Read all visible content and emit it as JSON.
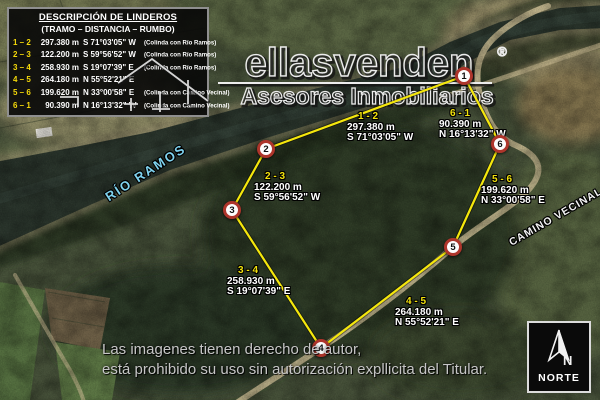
{
  "legend": {
    "title": "DESCRIPCIÓN DE LINDEROS",
    "subtitle": "(TRAMO – DISTANCIA – RUMBO)",
    "rows": [
      {
        "segment": "1 – 2",
        "distance": "297.380 m",
        "bearing": "S 71°03'05\" W",
        "note": "(Colinda con Río Ramos)"
      },
      {
        "segment": "2 – 3",
        "distance": "122.200 m",
        "bearing": "S 59°56'52\" W",
        "note": "(Colinda con Río Ramos)"
      },
      {
        "segment": "3 – 4",
        "distance": "258.930 m",
        "bearing": "S 19°07'39\" E",
        "note": "(Colinda con Río Ramos)"
      },
      {
        "segment": "4 – 5",
        "distance": "264.180 m",
        "bearing": "N 55°52'21\" E",
        "note": ""
      },
      {
        "segment": "5 – 6",
        "distance": "199.620 m",
        "bearing": "N 33°00'58\" E",
        "note": "(Colinda con Camino Vecinal)"
      },
      {
        "segment": "6 – 1",
        "distance": "90.390 m",
        "bearing": "N 16°13'32\" W",
        "note": "(Colinda con Camino Vecinal)"
      }
    ]
  },
  "watermark": {
    "brand": "ellasvenden",
    "registered": "®",
    "tagline": "Asesores Inmobiliarios"
  },
  "map_labels": {
    "river": "RÍO RAMOS",
    "road": "CAMINO VECINAL"
  },
  "markers": [
    {
      "label": "1"
    },
    {
      "label": "2"
    },
    {
      "label": "3"
    },
    {
      "label": "4"
    },
    {
      "label": "5"
    },
    {
      "label": "6"
    }
  ],
  "segment_labels": [
    {
      "id": "1 - 2",
      "distance": "297.380 m",
      "bearing": "S 71°03'05\" W"
    },
    {
      "id": "2 - 3",
      "distance": "122.200 m",
      "bearing": "S 59°56'52\" W"
    },
    {
      "id": "3 - 4",
      "distance": "258.930 m",
      "bearing": "S 19°07'39\" E"
    },
    {
      "id": "4 - 5",
      "distance": "264.180 m",
      "bearing": "N 55°52'21\" E"
    },
    {
      "id": "5 - 6",
      "distance": "199.620 m",
      "bearing": "N 33°00'58\" E"
    },
    {
      "id": "6 - 1",
      "distance": "90.390 m",
      "bearing": "N 16°13'32\" W"
    }
  ],
  "copyright": {
    "line1": "Las imagenes tienen derecho de autor,",
    "line2": "está prohibido su uso sin autorización expllicita del Titular."
  },
  "north": {
    "label": "NORTE",
    "letter": "N"
  },
  "colors": {
    "boundary": "#f5e70c",
    "marker_ring": "#ae352b",
    "segment_id": "#f2e20c",
    "legend_segment": "#f5d90a",
    "river_label": "#7fd3ef"
  }
}
